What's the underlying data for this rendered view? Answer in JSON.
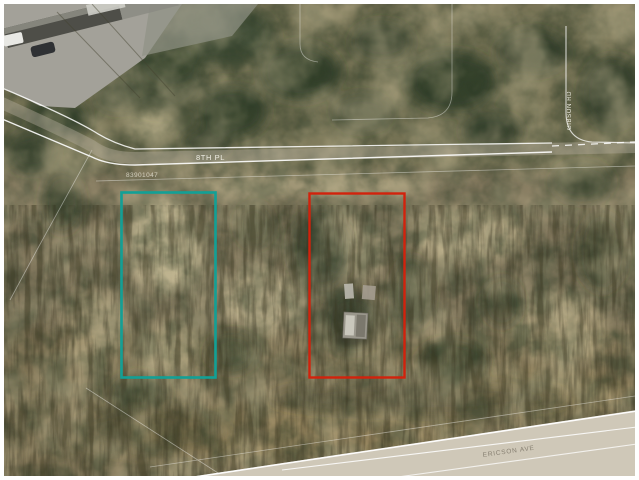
{
  "page": {
    "title": "Aerial parcel map photo"
  },
  "labels": {
    "street_top": "8TH PL",
    "parcel_number": "83901047",
    "street_bottom": "ERICSON AVE",
    "street_right": "GIBSON RD"
  },
  "parcels": {
    "teal": {
      "name": "boundary-highlight-parcel",
      "color": "#12A096",
      "x": 121,
      "y": 192,
      "width": 95,
      "height": 186
    },
    "red": {
      "name": "subject-lot-parcel",
      "color": "#D2220C",
      "x": 309,
      "y": 193,
      "width": 96,
      "height": 185
    }
  },
  "palette": {
    "frame": "#FFFFFF",
    "terrain_base": "#80765C",
    "canopy_dark": "#2C3A26",
    "canopy_tint": "#5C6B42",
    "clearing": "#C9BD98",
    "slope_brown": "#9C8A60",
    "road_pavement": "#CFC8B8",
    "road_line": "#FFFFFF",
    "lot_pavement": "#A3A199",
    "roof_dark": "#4E4E48"
  }
}
